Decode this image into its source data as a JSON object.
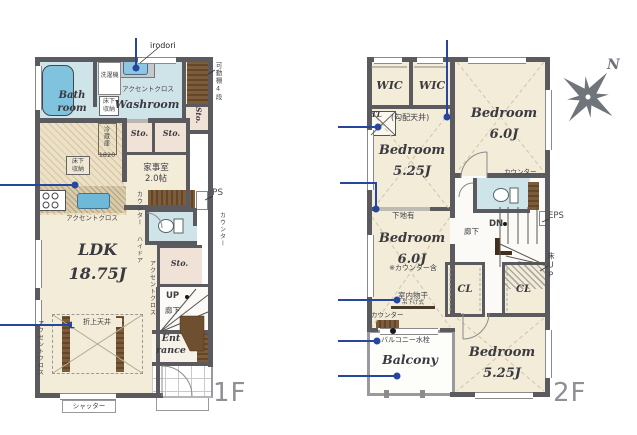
{
  "colors": {
    "wall": "#5b5b5f",
    "room_cream": "#f3ecd9",
    "wet_blue": "#cfe4e9",
    "tub_blue": "#7fc3df",
    "closet_pink": "#f0e2d7",
    "wood_brown": "#7d5c3c",
    "annotation_blue": "#27479e",
    "floor_label_gray": "#8f9094"
  },
  "compass": {
    "north": "N"
  },
  "plan1f": {
    "floor_label": "1F",
    "labels": {
      "irodori": "irodori",
      "movable_shelf": "可動棚4段",
      "washer": "洗濯機",
      "accent_cloth_washroom": "アクセントクロス",
      "bath": "Bath\nroom",
      "underfloor_storage_washroom": "床下\n収納",
      "washroom": "Washroom",
      "storage_side": "Sto.",
      "fridge": "冷蔵庫",
      "dim_1820": "1820",
      "underfloor_storage_kitchen": "床下\n収納",
      "storage_1": "Sto.",
      "storage_2": "Sto.",
      "utility_room": "家事室\n2.0帖",
      "pipe_space": "PS",
      "counter_left": "カウンター",
      "counter_right": "カウンター",
      "accent_cloth_kitchen": "アクセントクロス",
      "high_door": "ハイドア",
      "storage_3": "Sto.",
      "ldk": "LDK\n18.75J",
      "accent_cloth_stair": "アクセントクロス",
      "up": "UP",
      "hallway": "廊下",
      "coffered_ceiling": "折上天井",
      "entrance": "Ent\nrance",
      "accent_cloth_left": "アクセントクロス",
      "shutter": "シャッター"
    }
  },
  "plan2f": {
    "floor_label": "2F",
    "labels": {
      "wic_1": "WIC",
      "wic_2": "WIC",
      "top_light": "TL",
      "sloped_ceiling": "(勾配天井)",
      "bedroom_ne": "Bedroom\n6.0J",
      "counter_ne": "カウンター",
      "bedroom_nw": "Bedroom\n5.25J",
      "base_board": "下地有",
      "bedroom_w": "Bedroom\n6.0J",
      "counter_included": "※カウンター含",
      "indoor_drying": "室内物干",
      "hanging_type": "吊下げ式",
      "counter_sw": "カウンター",
      "balcony_faucet": "バルコニー水栓",
      "balcony": "Balcony",
      "down": "DN",
      "hallway": "廊下",
      "eps": "EPS",
      "floor_up": "床UP",
      "closet_1": "CL",
      "closet_2": "CL",
      "bedroom_se": "Bedroom\n5.25J"
    }
  }
}
